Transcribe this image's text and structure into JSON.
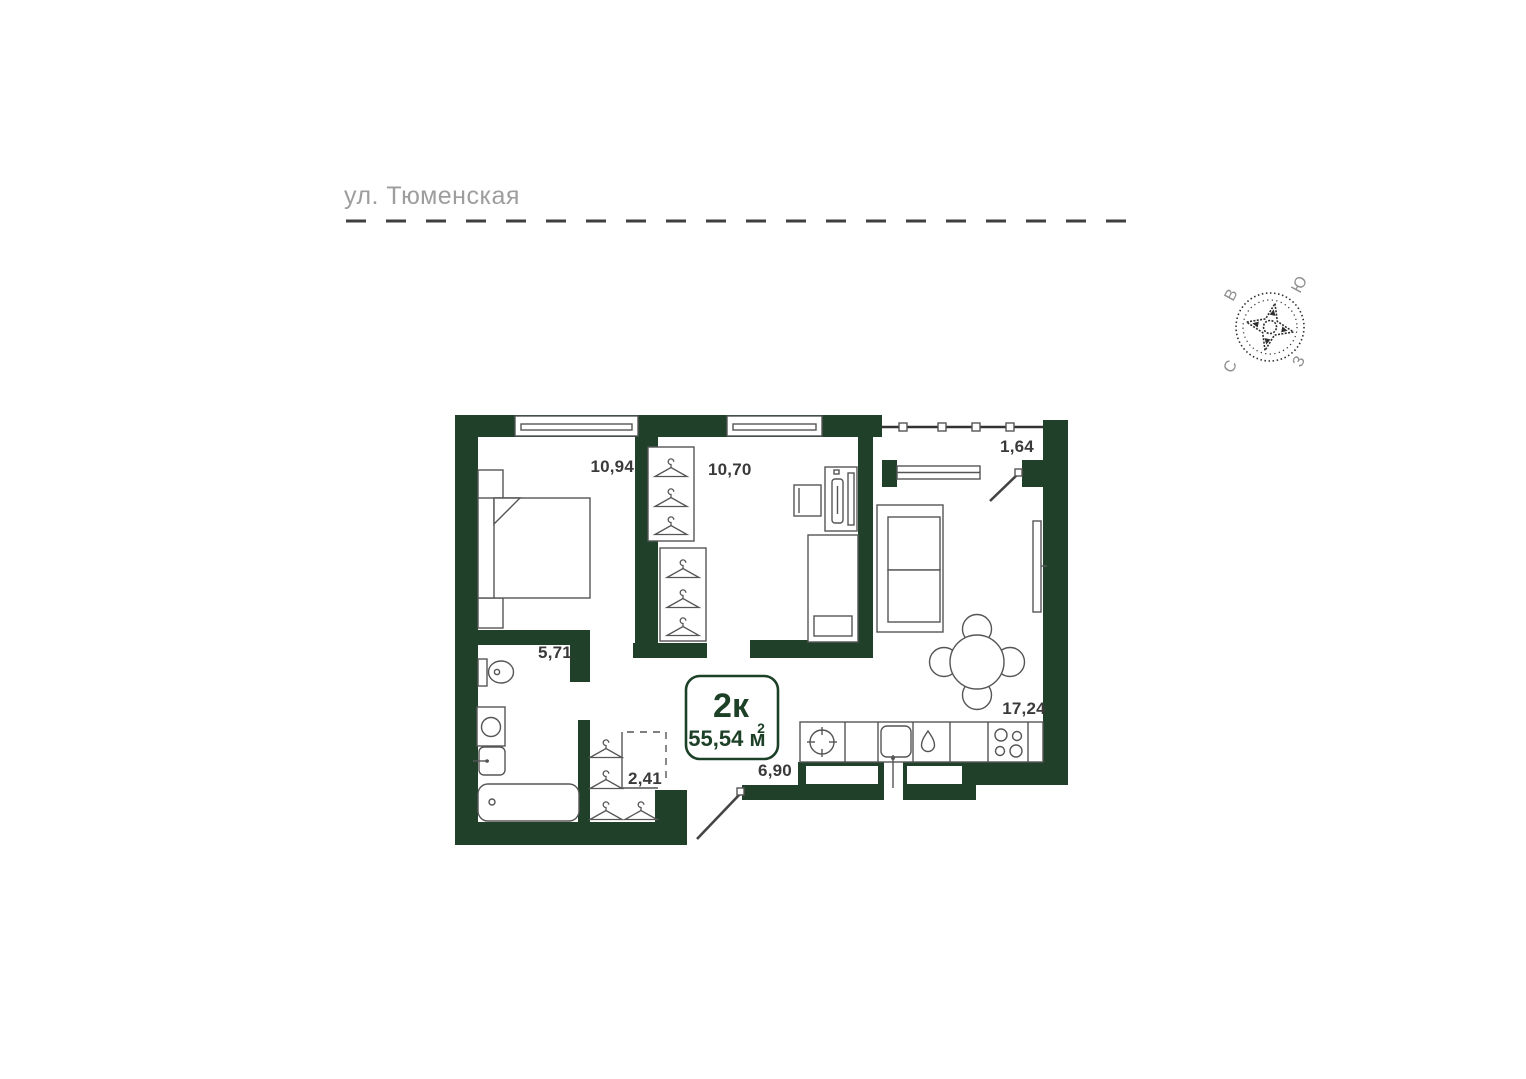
{
  "street": {
    "label": "ул. Тюменская"
  },
  "compass": {
    "north": "С",
    "south": "Ю",
    "east": "В",
    "west": "З"
  },
  "apartment_badge": {
    "rooms_label": "2к",
    "area_label": "55,54 м",
    "area_superscript": "2"
  },
  "room_areas": {
    "bedroom_1": "10,94",
    "bedroom_2": "10,70",
    "balcony": "1,64",
    "bathroom": "5,71",
    "wardrobe": "2,41",
    "hallway": "6,90",
    "living_kitchen": "17,24"
  },
  "colors": {
    "wall": "#20402a",
    "badge_accent": "#1d4127",
    "room_label_text": "#3a3a3a",
    "street_label_text": "#9d9d9d",
    "furniture_outline": "#555555",
    "dashed_street_line": "#3f3f3f"
  }
}
